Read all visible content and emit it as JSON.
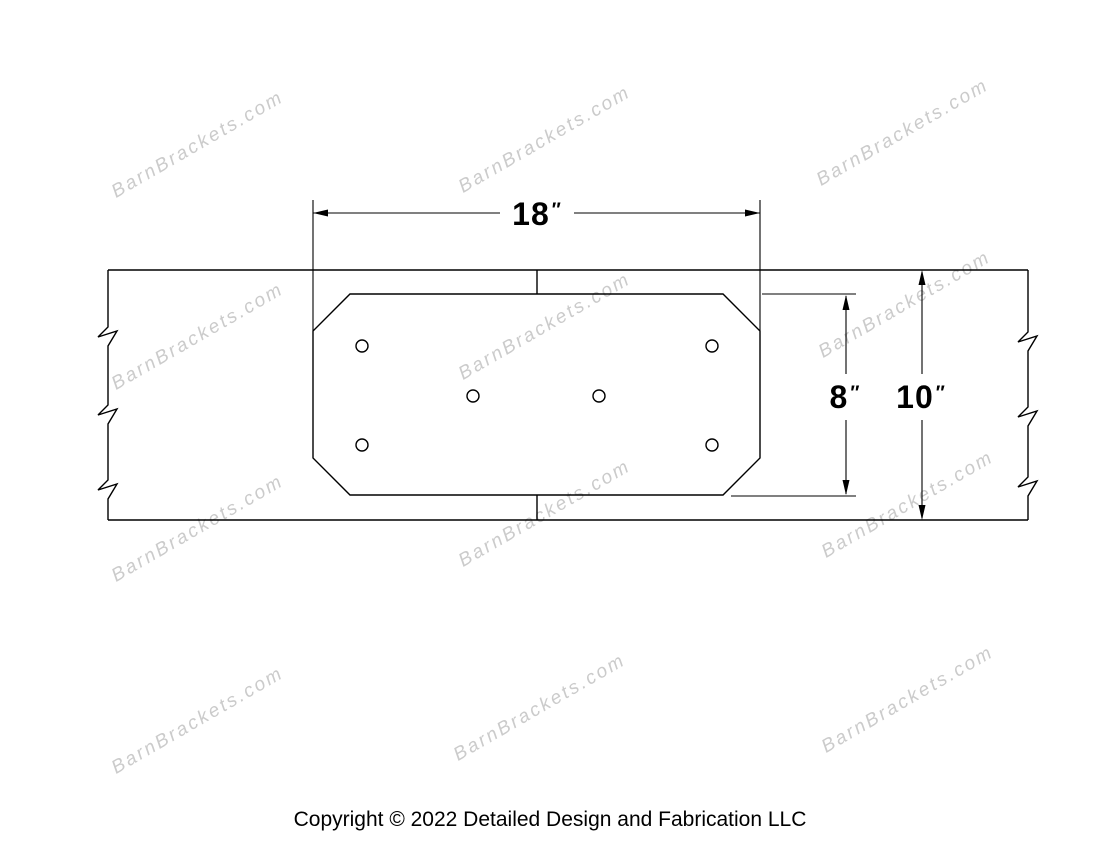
{
  "drawing": {
    "title_hint": "Octagon shaped timber bracket plate for straight beams, face view",
    "line_color": "#000000",
    "dimensions": {
      "width": {
        "value": "18",
        "unit": "″"
      },
      "plate_height": {
        "value": "8",
        "unit": "″"
      },
      "beam_height": {
        "value": "10",
        "unit": "″"
      }
    },
    "hole_count": 6
  },
  "watermark": {
    "text": "BarnBrackets.com",
    "color": "#cbcbcb"
  },
  "footer": {
    "copyright": "Copyright © 2022 Detailed Design and Fabrication LLC"
  }
}
